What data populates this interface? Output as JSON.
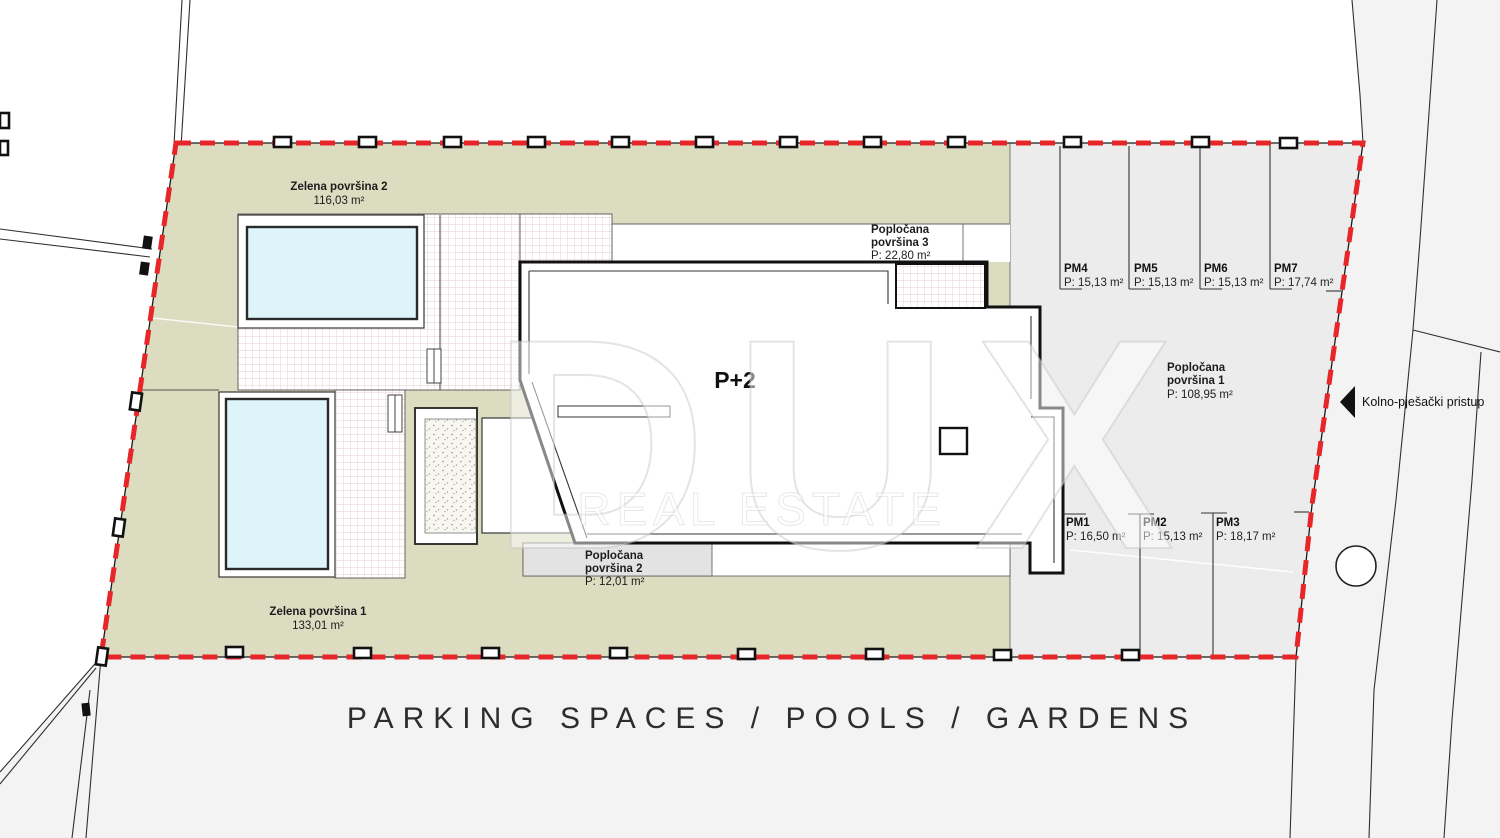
{
  "title": "PARKING SPACES / POOLS / GARDENS",
  "watermark": {
    "line1": "DUX",
    "line2": "REAL ESTATE"
  },
  "site": {
    "building_label": "P+2",
    "access_label": "Kolno-pješački pristup",
    "green_areas": [
      {
        "name": "Zelena površina 2",
        "area": "116,03 m²"
      },
      {
        "name": "Zelena površina 1",
        "area": "133,01 m²"
      }
    ],
    "paved_areas": [
      {
        "name_line1": "Popločana",
        "name_line2": "površina 1",
        "area": "P: 108,95 m²"
      },
      {
        "name_line1": "Popločana",
        "name_line2": "površina 2",
        "area": "P: 12,01 m²"
      },
      {
        "name_line1": "Popločana",
        "name_line2": "površina 3",
        "area": "P: 22,80 m²"
      }
    ],
    "parking_spaces": [
      {
        "id": "PM1",
        "area": "P: 16,50 m²"
      },
      {
        "id": "PM2",
        "area": "P: 15,13 m²"
      },
      {
        "id": "PM3",
        "area": "P: 18,17 m²"
      },
      {
        "id": "PM4",
        "area": "P: 15,13 m²"
      },
      {
        "id": "PM5",
        "area": "P: 15,13 m²"
      },
      {
        "id": "PM6",
        "area": "P: 15,13 m²"
      },
      {
        "id": "PM7",
        "area": "P: 17,74 m²"
      }
    ]
  },
  "colors": {
    "boundary_red": "#e8262a",
    "green_area": "#dbdcc0",
    "parking_gray": "#ececec",
    "road_gray": "#f2f3f2",
    "pool_blue": "#ddf4f8"
  }
}
